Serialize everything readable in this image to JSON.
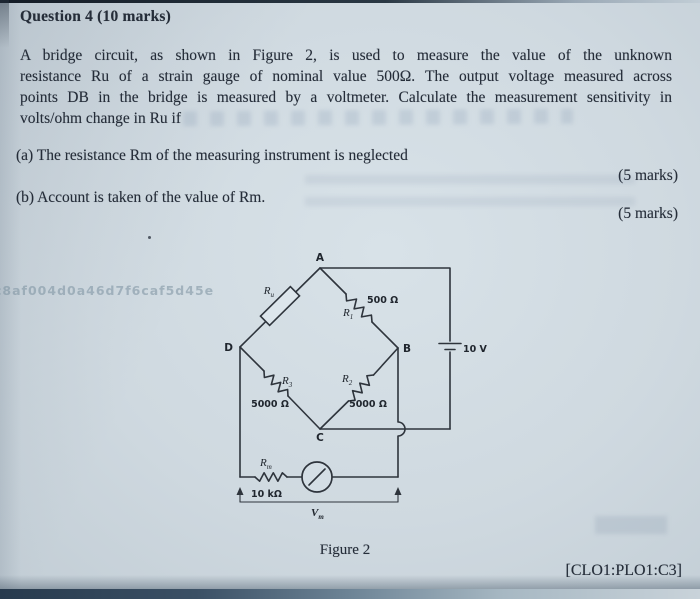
{
  "question": {
    "heading": "Question 4 (10 marks)",
    "body_lines": [
      "A bridge circuit, as shown in Figure 2, is used to measure the value of the unknown",
      "resistance Ru of a strain gauge of nominal value 500Ω. The output voltage measured across",
      "points DB in the bridge is measured by a voltmeter. Calculate the measurement sensitivity in",
      "volts/ohm change in Ru if"
    ],
    "item_a": "(a) The resistance Rm of the measuring instrument is neglected",
    "item_a_marks": "(5 marks)",
    "item_b": "(b) Account is taken of the value of Rm.",
    "item_b_marks": "(5 marks)",
    "clo_tag": "[CLO1:PLO1:C3]"
  },
  "figure": {
    "caption": "Figure 2",
    "nodes": {
      "top": "A",
      "right": "B",
      "bottom": "C",
      "left": "D"
    },
    "labels": {
      "ru_base": "R",
      "ru_sub": "u",
      "r1_base": "R",
      "r1_sub": "1",
      "r1_value": "500 Ω",
      "r2_base": "R",
      "r2_sub": "2",
      "r2_value": "5000 Ω",
      "r3_base": "R",
      "r3_sub": "3",
      "r3_value": "5000 Ω",
      "rm_base": "R",
      "rm_sub": "m",
      "rm_value": "10 kΩ",
      "vm_base": "V",
      "vm_sub": "m",
      "battery_value": "10 V"
    }
  },
  "artifacts": {
    "watermark": "c8af004d0a46d7f6caf5d45e"
  },
  "colors": {
    "ink": "#252d39",
    "paper": "#cfd9e0",
    "scan_edge_dark": "#273a4d"
  }
}
